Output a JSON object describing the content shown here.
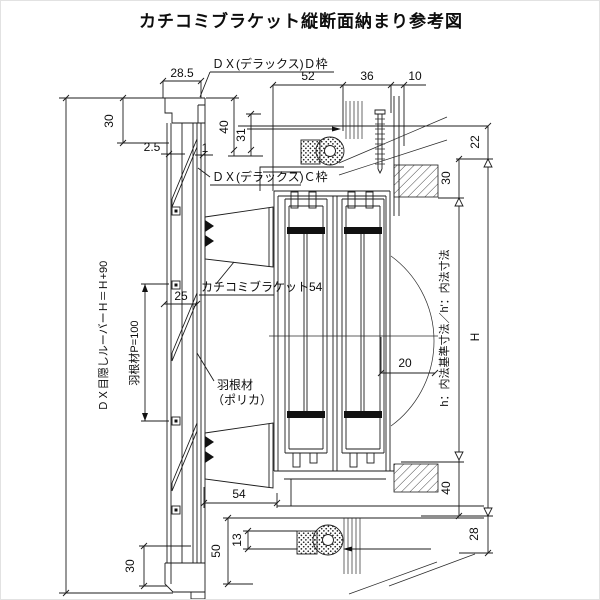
{
  "title": "カチコミブラケット縦断面納まり参考図",
  "labels": {
    "dx_d_frame": "ＤＸ(デラックス)Ｄ枠",
    "dx_c_frame": "ＤＸ(デラックス)Ｃ枠",
    "bracket54": "カチコミブラケット54",
    "blade_material_1": "羽根材",
    "blade_material_2": "（ポリカ）",
    "blade_pitch": "羽根材P=100",
    "louver_height": "ＤＸ目隠しルーバーＨ＝Ｈ+90",
    "inner_dim_note": "h：内法基準寸法／h'：内法寸法"
  },
  "dims": {
    "top_28_5": "28.5",
    "top_left_30": "30",
    "gap_2_5": "2.5",
    "gap_1": "1",
    "head_40": "40",
    "head_31": "31",
    "top_52": "52",
    "top_36": "36",
    "top_10": "10",
    "right_22": "22",
    "right_30": "30",
    "louver_25": "25",
    "mid_20": "20",
    "height_H": "H",
    "bottom_54": "54",
    "bottom_50": "50",
    "bottom_13": "13",
    "bottom_left_30": "30",
    "right_40": "40",
    "right_28": "28"
  },
  "colors": {
    "line": "#1c1c1c",
    "background": "#ffffff"
  }
}
